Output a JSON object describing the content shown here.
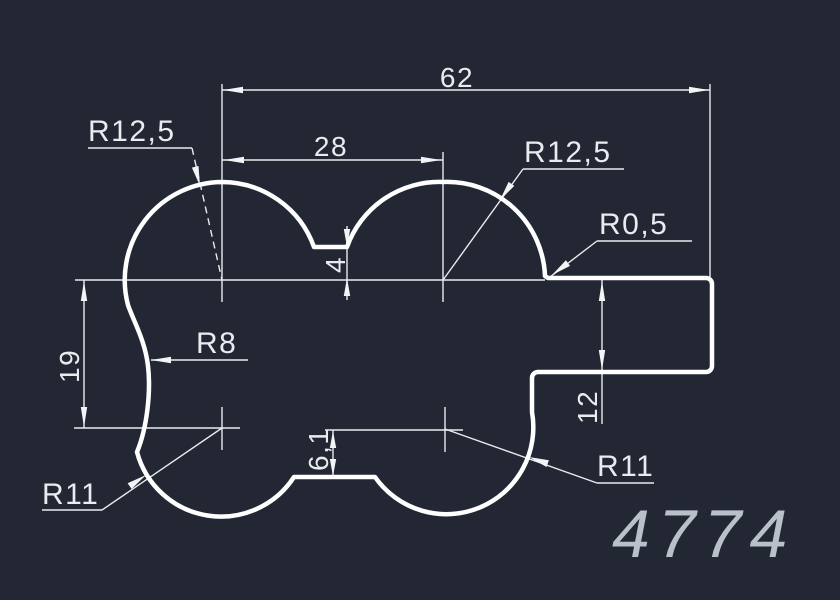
{
  "colors": {
    "background": "#222733",
    "line_color": "#eef0f2",
    "profile_color": "#ffffff",
    "part_number_color": "#b9c0c9"
  },
  "drawing": {
    "dimensions": {
      "total_width": {
        "label": "62"
      },
      "lobe_spacing": {
        "label": "28"
      },
      "left_height": {
        "label": "19"
      },
      "top_notch_depth": {
        "label": "4"
      },
      "bottom_notch_depth": {
        "label": "6,1"
      },
      "tab_height": {
        "label": "12"
      }
    },
    "radii": {
      "top_left_lobe": {
        "label": "R12,5"
      },
      "top_right_lobe": {
        "label": "R12,5"
      },
      "step_corner": {
        "label": "R0,5"
      },
      "left_cove": {
        "label": "R8"
      },
      "bottom_left_lobe": {
        "label": "R11"
      },
      "bottom_right_lobe": {
        "label": "R11"
      }
    },
    "part_number": {
      "label": "4774"
    }
  }
}
